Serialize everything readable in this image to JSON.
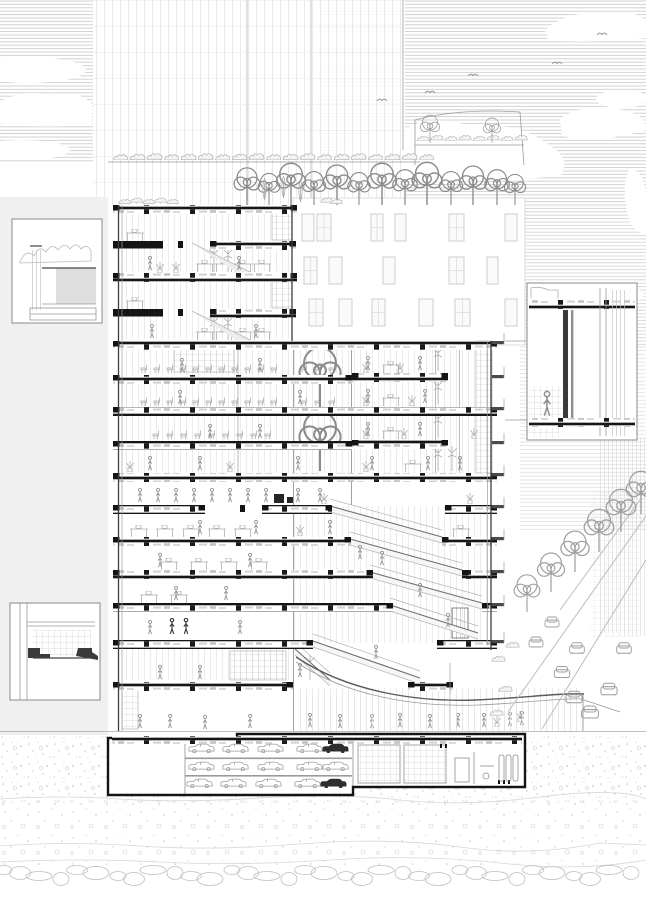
{
  "meta": {
    "kind": "architectural-section-drawing",
    "width": 646,
    "height": 913,
    "visible_text": []
  },
  "colors": {
    "paper": "#ffffff",
    "ink": "#151515",
    "medium": "#969696",
    "light": "#bdbdbd",
    "faint": "#dcdcdc",
    "panel": "#f0f0f0",
    "sky_hatch": "#c8c8c8"
  },
  "scene": {
    "sky": {
      "hatch_style": "horizontal-lines",
      "cloud_count": 8,
      "bird_count": 5
    },
    "background": {
      "glass_tower_grid": true,
      "white_building_window_rows": 3,
      "city_blocks_right": 2
    },
    "section_building": {
      "floor_count": 15,
      "has_atrium_trees": true,
      "has_cascading_stairs": true,
      "basement_parking_levels": 3,
      "roof_gardens": 3
    },
    "detail_callouts": [
      {
        "position": "top-left"
      },
      {
        "position": "bottom-left"
      },
      {
        "position": "middle-right"
      }
    ],
    "street": {
      "car_count": 8,
      "tree_count": 6
    },
    "ground": {
      "texture": "stipple",
      "pebble_band": true
    }
  },
  "art": {
    "slabs": [
      {
        "y": 205,
        "seg": [
          [
            113,
            184
          ]
        ]
      },
      {
        "y": 241,
        "seg": [
          [
            113,
            50,
            1
          ],
          [
            210,
            86
          ]
        ],
        "col": 178
      },
      {
        "y": 273,
        "seg": [
          [
            113,
            184
          ]
        ]
      },
      {
        "y": 309,
        "seg": [
          [
            113,
            50,
            1
          ],
          [
            210,
            86
          ]
        ],
        "col": 178
      },
      {
        "y": 341,
        "seg": [
          [
            113,
            384
          ]
        ]
      },
      {
        "y": 373,
        "seg": [
          [
            352,
            96
          ]
        ]
      },
      {
        "y": 375,
        "seg": [
          [
            113,
            239
          ]
        ]
      },
      {
        "y": 407,
        "seg": [
          [
            113,
            384
          ]
        ]
      },
      {
        "y": 440,
        "seg": [
          [
            352,
            96
          ]
        ]
      },
      {
        "y": 441,
        "seg": [
          [
            113,
            239
          ]
        ]
      },
      {
        "y": 473,
        "seg": [
          [
            113,
            384
          ]
        ]
      },
      {
        "y": 505,
        "seg": [
          [
            113,
            92
          ],
          [
            262,
            70
          ],
          [
            445,
            52
          ]
        ],
        "col": 240
      },
      {
        "y": 537,
        "seg": [
          [
            113,
            238
          ],
          [
            442,
            55
          ]
        ]
      },
      {
        "y": 570,
        "seg": [
          [
            113,
            260
          ],
          [
            462,
            35
          ]
        ]
      },
      {
        "y": 603,
        "seg": [
          [
            113,
            280
          ],
          [
            482,
            15
          ]
        ]
      },
      {
        "y": 640,
        "seg": [
          [
            113,
            200
          ],
          [
            437,
            60
          ]
        ]
      },
      {
        "y": 682,
        "seg": [
          [
            113,
            180
          ],
          [
            408,
            45
          ]
        ]
      }
    ],
    "stubsRight": [
      341,
      375,
      407,
      441,
      473,
      505,
      537,
      570,
      603,
      640
    ],
    "flights": [
      [
        330,
        506,
        442,
        537
      ],
      [
        350,
        539,
        462,
        570
      ],
      [
        370,
        572,
        482,
        603
      ],
      [
        390,
        605,
        478,
        633
      ],
      [
        313,
        641,
        420,
        678
      ],
      [
        295,
        649,
        330,
        680
      ]
    ],
    "towerStairs": [
      [
        192,
        243,
        250,
        272
      ],
      [
        192,
        311,
        250,
        340
      ]
    ],
    "windows": [
      {
        "y": 214,
        "h": 27,
        "cells": [
          [
            302,
            12,
            0
          ],
          [
            317,
            14,
            1
          ],
          [
            371,
            12,
            1
          ],
          [
            395,
            11,
            0
          ],
          [
            449,
            15,
            1
          ],
          [
            505,
            12,
            0
          ]
        ]
      },
      {
        "y": 257,
        "h": 27,
        "cells": [
          [
            304,
            13,
            1
          ],
          [
            329,
            13,
            0
          ],
          [
            383,
            12,
            0
          ],
          [
            449,
            15,
            1
          ],
          [
            487,
            11,
            0
          ]
        ]
      },
      {
        "y": 299,
        "h": 27,
        "cells": [
          [
            309,
            14,
            1
          ],
          [
            339,
            13,
            0
          ],
          [
            372,
            13,
            1
          ],
          [
            419,
            14,
            0
          ],
          [
            455,
            15,
            1
          ],
          [
            505,
            12,
            0
          ]
        ]
      }
    ],
    "bgTrees": [
      [
        247,
        205,
        40
      ],
      [
        269,
        205,
        34
      ],
      [
        291,
        205,
        45
      ],
      [
        314,
        205,
        36
      ],
      [
        337,
        205,
        43
      ],
      [
        359,
        205,
        35
      ],
      [
        382,
        205,
        45
      ],
      [
        405,
        205,
        38
      ],
      [
        427,
        205,
        46
      ],
      [
        451,
        205,
        36
      ],
      [
        473,
        205,
        42
      ],
      [
        497,
        205,
        38
      ],
      [
        515,
        205,
        33
      ]
    ],
    "terraceTrees": [
      [
        430,
        143,
        30
      ],
      [
        492,
        143,
        27
      ]
    ],
    "cypresses": [
      [
        264,
        204,
        30
      ],
      [
        283,
        204,
        34
      ],
      [
        300,
        204,
        26
      ]
    ],
    "atriumTrees": [
      [
        320,
        407,
        64
      ],
      [
        320,
        471,
        64
      ]
    ],
    "streetTrees": [
      [
        527,
        612,
        40
      ],
      [
        551,
        592,
        42
      ],
      [
        575,
        572,
        44
      ],
      [
        599,
        552,
        46
      ],
      [
        621,
        532,
        46
      ],
      [
        641,
        514,
        46
      ]
    ],
    "shrubsA": [
      112,
      129,
      146,
      163,
      180,
      197,
      214,
      231,
      248,
      265,
      282,
      299,
      316,
      333,
      350,
      367,
      384,
      401,
      418
    ],
    "shrubsA_y": 160,
    "terraceShrubs": [
      416,
      430,
      444,
      458,
      472,
      486,
      500,
      514
    ],
    "terraceShrubs_y": 141,
    "roofShrubs": [
      118,
      130,
      142,
      154,
      166,
      320,
      330
    ],
    "roofShrubs_y": 204,
    "streetShrubs": [
      [
        498,
        662
      ],
      [
        505,
        692
      ],
      [
        496,
        716
      ],
      [
        512,
        648
      ]
    ],
    "mullionZones": [
      [
        123,
        214,
        168,
        57
      ],
      [
        123,
        282,
        168,
        57
      ],
      [
        123,
        343,
        368,
        130
      ],
      [
        294,
        506,
        196,
        137
      ],
      [
        123,
        647,
        168,
        33
      ],
      [
        298,
        688,
        284,
        42
      ]
    ],
    "shelves": [
      [
        272,
        213,
        20,
        27,
        0
      ],
      [
        272,
        281,
        20,
        27,
        0
      ],
      [
        174,
        343,
        60,
        29,
        0
      ],
      [
        122,
        685,
        16,
        44,
        0
      ],
      [
        230,
        651,
        56,
        29,
        0
      ],
      [
        452,
        608,
        16,
        30,
        1
      ],
      [
        476,
        341,
        16,
        132,
        0
      ]
    ],
    "desks": [
      [
        126,
        241
      ],
      [
        126,
        309
      ],
      [
        196,
        272
      ],
      [
        215,
        272
      ],
      [
        234,
        272
      ],
      [
        253,
        272
      ],
      [
        196,
        340
      ],
      [
        215,
        340
      ],
      [
        234,
        340
      ],
      [
        253,
        340
      ],
      [
        382,
        373
      ],
      [
        382,
        406
      ],
      [
        382,
        439
      ],
      [
        404,
        472
      ],
      [
        130,
        537
      ],
      [
        156,
        537
      ],
      [
        182,
        537
      ],
      [
        208,
        537
      ],
      [
        234,
        537
      ],
      [
        160,
        570
      ],
      [
        190,
        570
      ],
      [
        220,
        570
      ],
      [
        250,
        570
      ],
      [
        140,
        603
      ],
      [
        170,
        603
      ],
      [
        452,
        537
      ]
    ],
    "chairRows": [
      {
        "x0": 140,
        "y": 373,
        "n": 11,
        "step": 13
      },
      {
        "x0": 140,
        "y": 406,
        "n": 11,
        "step": 13
      },
      {
        "x0": 152,
        "y": 439,
        "n": 9,
        "step": 14
      },
      {
        "x0": 300,
        "y": 373,
        "n": 3,
        "step": 14
      },
      {
        "x0": 300,
        "y": 406,
        "n": 3,
        "step": 14
      }
    ],
    "potted": [
      [
        160,
        273
      ],
      [
        176,
        273
      ],
      [
        366,
        373
      ],
      [
        400,
        373
      ],
      [
        366,
        406
      ],
      [
        412,
        406
      ],
      [
        366,
        439
      ],
      [
        404,
        439
      ],
      [
        366,
        472
      ],
      [
        300,
        536
      ],
      [
        324,
        504
      ],
      [
        470,
        504
      ],
      [
        474,
        439
      ],
      [
        230,
        472
      ],
      [
        130,
        472
      ],
      [
        497,
        727
      ],
      [
        520,
        722
      ]
    ],
    "tallPlants": [
      [
        214,
        272
      ],
      [
        228,
        272
      ],
      [
        214,
        340
      ],
      [
        228,
        340
      ],
      [
        438,
        371
      ],
      [
        438,
        404
      ],
      [
        438,
        437
      ],
      [
        438,
        471
      ],
      [
        452,
        471
      ],
      [
        310,
        680
      ]
    ],
    "people": [
      [
        150,
        271
      ],
      [
        239,
        271
      ],
      [
        152,
        339
      ],
      [
        256,
        339
      ],
      [
        182,
        373
      ],
      [
        260,
        373
      ],
      [
        300,
        405
      ],
      [
        180,
        405
      ],
      [
        368,
        371
      ],
      [
        420,
        371
      ],
      [
        368,
        404
      ],
      [
        425,
        404
      ],
      [
        368,
        437
      ],
      [
        420,
        437
      ],
      [
        372,
        471
      ],
      [
        428,
        471
      ],
      [
        210,
        439
      ],
      [
        260,
        439
      ],
      [
        150,
        471
      ],
      [
        200,
        471
      ],
      [
        298,
        471
      ],
      [
        460,
        471
      ],
      [
        140,
        503
      ],
      [
        158,
        503
      ],
      [
        176,
        503
      ],
      [
        194,
        503
      ],
      [
        212,
        503
      ],
      [
        230,
        503
      ],
      [
        248,
        503
      ],
      [
        266,
        503
      ],
      [
        298,
        503
      ],
      [
        320,
        503
      ],
      [
        200,
        535
      ],
      [
        256,
        535
      ],
      [
        330,
        535
      ],
      [
        360,
        560
      ],
      [
        382,
        566
      ],
      [
        420,
        598
      ],
      [
        448,
        628
      ],
      [
        376,
        660
      ],
      [
        160,
        568
      ],
      [
        250,
        568
      ],
      [
        176,
        601
      ],
      [
        226,
        601
      ],
      [
        150,
        635
      ],
      [
        240,
        635
      ],
      [
        160,
        680
      ],
      [
        200,
        680
      ],
      [
        300,
        678
      ],
      [
        140,
        729
      ],
      [
        170,
        729
      ],
      [
        205,
        730
      ],
      [
        250,
        729
      ],
      [
        310,
        728
      ],
      [
        340,
        729
      ],
      [
        372,
        729
      ],
      [
        400,
        728
      ],
      [
        430,
        729
      ],
      [
        458,
        728
      ],
      [
        484,
        728
      ],
      [
        510,
        727
      ],
      [
        522,
        726
      ]
    ],
    "peopleDark": [
      [
        172,
        635
      ],
      [
        186,
        635
      ]
    ],
    "basementCars": [
      [
        188,
        743,
        0
      ],
      [
        222,
        743,
        0
      ],
      [
        257,
        743,
        0
      ],
      [
        296,
        743,
        0
      ],
      [
        322,
        743,
        1
      ],
      [
        188,
        761,
        0
      ],
      [
        222,
        761,
        0
      ],
      [
        257,
        761,
        0
      ],
      [
        296,
        761,
        0
      ],
      [
        322,
        761,
        0
      ],
      [
        186,
        778,
        0
      ],
      [
        220,
        778,
        0
      ],
      [
        255,
        778,
        0
      ],
      [
        294,
        778,
        0
      ],
      [
        320,
        778,
        1
      ]
    ],
    "racks": [
      [
        358,
        745,
        42,
        38
      ],
      [
        404,
        745,
        42,
        38
      ]
    ],
    "tanks": [
      [
        499,
        755
      ],
      [
        506,
        755
      ],
      [
        513,
        755
      ]
    ],
    "streetCars": [
      [
        552,
        622,
        1
      ],
      [
        536,
        642,
        1
      ],
      [
        577,
        648,
        1.05
      ],
      [
        562,
        672,
        1.1
      ],
      [
        609,
        689,
        1.15
      ],
      [
        574,
        697,
        1.15
      ],
      [
        590,
        712,
        1.2
      ],
      [
        624,
        648,
        1.05
      ]
    ],
    "roadLines": [
      [
        646,
        516,
        508,
        712
      ],
      [
        646,
        560,
        542,
        729
      ],
      [
        640,
        500,
        560,
        610
      ]
    ],
    "birds": [
      [
        557,
        62
      ],
      [
        473,
        74
      ],
      [
        430,
        91
      ],
      [
        602,
        33
      ],
      [
        382,
        99
      ]
    ],
    "balcStub": {
      "x": 492,
      "w": 12
    },
    "darkBits": [
      [
        274,
        494,
        10,
        9
      ],
      [
        287,
        497,
        6,
        6
      ]
    ]
  }
}
